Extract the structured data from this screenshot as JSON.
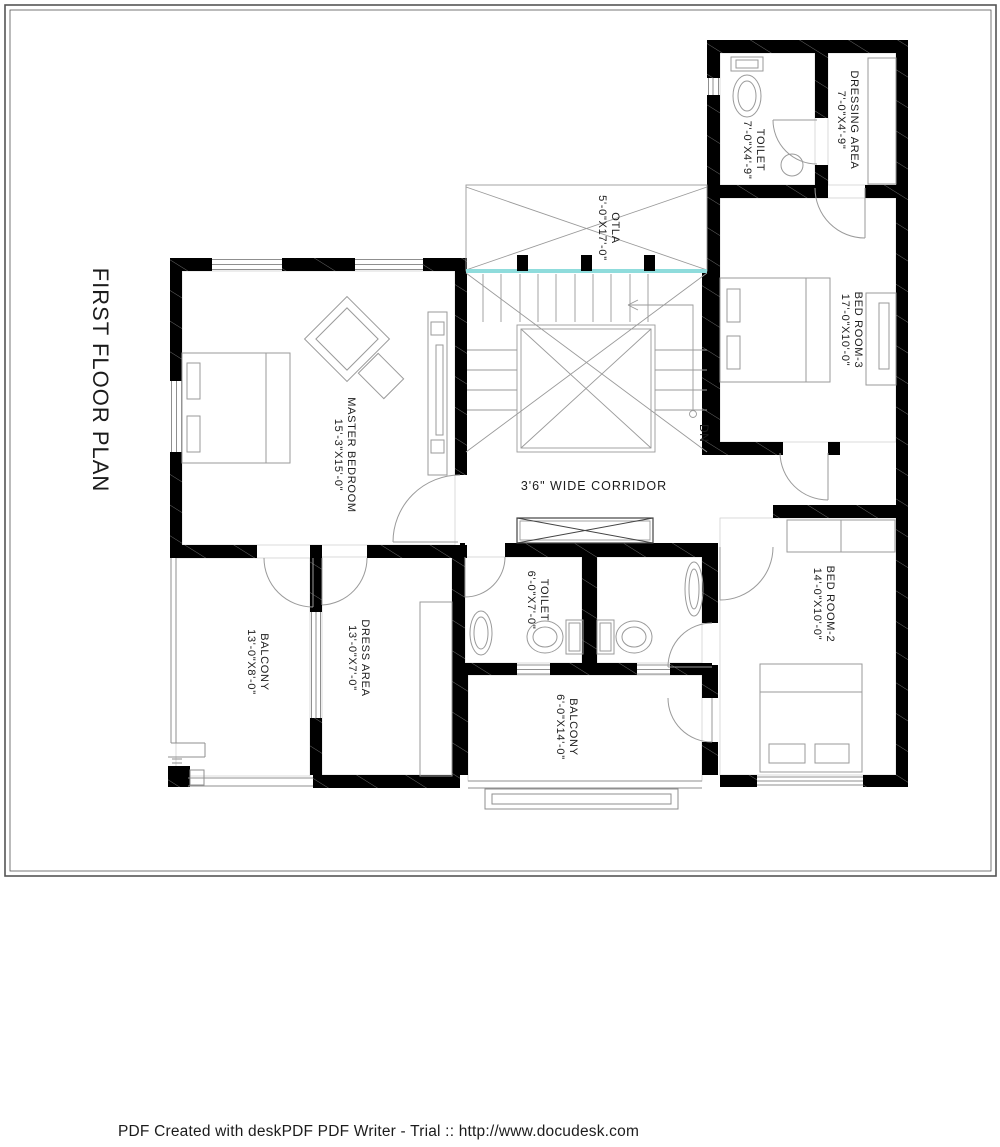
{
  "page": {
    "title": "FIRST FLOOR PLAN",
    "footer": "PDF Created with deskPDF PDF Writer - Trial :: http://www.docudesk.com"
  },
  "plan": {
    "corridor_label": "3'6\" WIDE CORRIDOR",
    "stair_down_label": "DN",
    "colors": {
      "wall": "#000000",
      "glass_teal": "#8fdcdc"
    },
    "rooms": [
      {
        "id": "toilet-top",
        "name": "TOILET",
        "dims": "7'-0\"X4'-9\""
      },
      {
        "id": "dressing-area",
        "name": "DRESSING AREA",
        "dims": "7'-0\"X4'-9\""
      },
      {
        "id": "bed-room-3",
        "name": "BED ROOM-3",
        "dims": "17'-0\"X10'-0\""
      },
      {
        "id": "otla",
        "name": "OTLA",
        "dims": "5'-0\"X17'-0\""
      },
      {
        "id": "master-bedroom",
        "name": "MASTER BEDROOM",
        "dims": "15'-3\"X15'-0\""
      },
      {
        "id": "toilet-mid",
        "name": "TOILET",
        "dims": "6'-0\"X7'-0\""
      },
      {
        "id": "balcony-left",
        "name": "BALCONY",
        "dims": "13'-0\"X8'-0\""
      },
      {
        "id": "dress-area",
        "name": "DRESS AREA",
        "dims": "13'-0\"X7'-0\""
      },
      {
        "id": "balcony-mid",
        "name": "BALCONY",
        "dims": "6'-0\"X14'-0\""
      },
      {
        "id": "bed-room-2",
        "name": "BED ROOM-2",
        "dims": "14'-0\"X10'-0\""
      }
    ]
  }
}
